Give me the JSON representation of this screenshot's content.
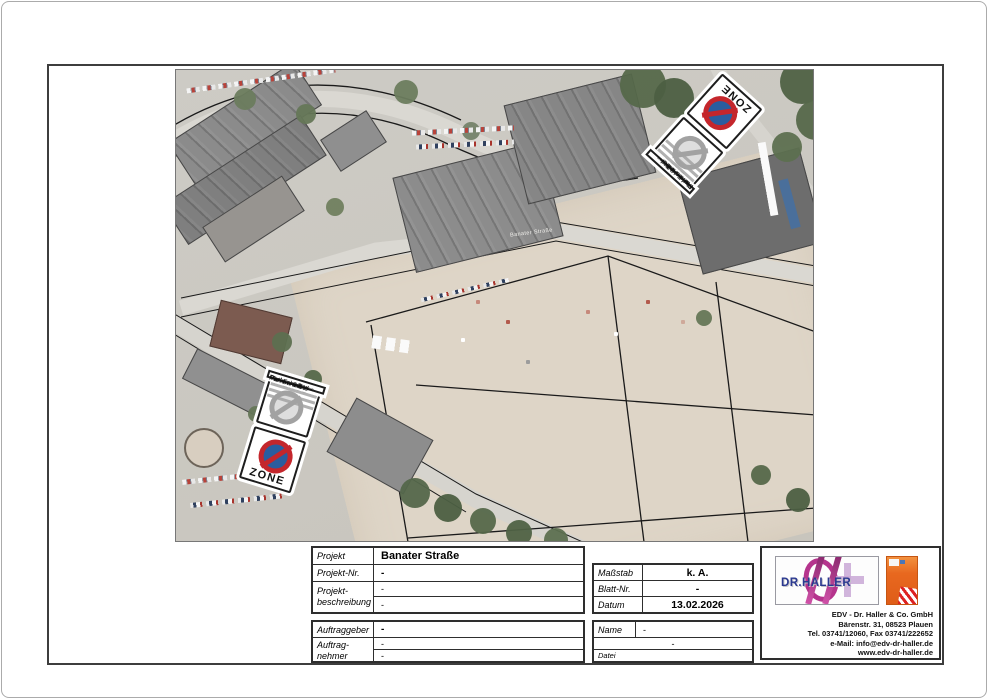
{
  "map": {
    "street_label": "Banater Straße"
  },
  "signs": {
    "zone_label": "ZONE",
    "panel_lines": [
      "Parken mit",
      "Parkscheibe",
      "Mo.-Fr. 3 Std",
      "in gekennzeichneten",
      "Flächen, nur PKW"
    ]
  },
  "titleblock": {
    "projekt_label": "Projekt",
    "projekt_value": "Banater Straße",
    "projekt_nr_label": "Projekt-Nr.",
    "projekt_nr_value": "-",
    "beschreibung_label_1": "Projekt-",
    "beschreibung_label_2": "beschreibung",
    "beschreibung_value_1": "-",
    "beschreibung_value_2": "-",
    "massstab_label": "Maßstab",
    "massstab_value": "k. A.",
    "blatt_label": "Blatt-Nr.",
    "blatt_value": "-",
    "datum_label": "Datum",
    "datum_value": "13.02.2026",
    "auftraggeber_label": "Auftraggeber",
    "auftraggeber_value": "-",
    "auftragnehmer_label_1": "Auftrag-",
    "auftragnehmer_label_2": "nehmer",
    "auftragnehmer_value_1": "-",
    "auftragnehmer_value_2": "-",
    "name_label": "Name",
    "name_value": "-",
    "file_mid_value": "-",
    "datei_label": "Datei"
  },
  "company": {
    "logo_text": "DR.HALLER",
    "address_lines": [
      "EDV - Dr. Haller & Co. GmbH",
      "Bärenstr. 31, 08523 Plauen",
      "Tel. 03741/12060, Fax 03741/222652",
      "e-Mail: info@edv-dr-haller.de",
      "www.edv-dr-haller.de"
    ]
  },
  "colors": {
    "sign_red": "#c4262c",
    "sign_blue": "#2a5d9f",
    "sign_gray": "#a2a2a2",
    "logo_magenta": "#b5348d",
    "logo_navy": "#2b3990",
    "brochure_orange": "#e8681f",
    "frame_gray": "#3d3d3d"
  }
}
